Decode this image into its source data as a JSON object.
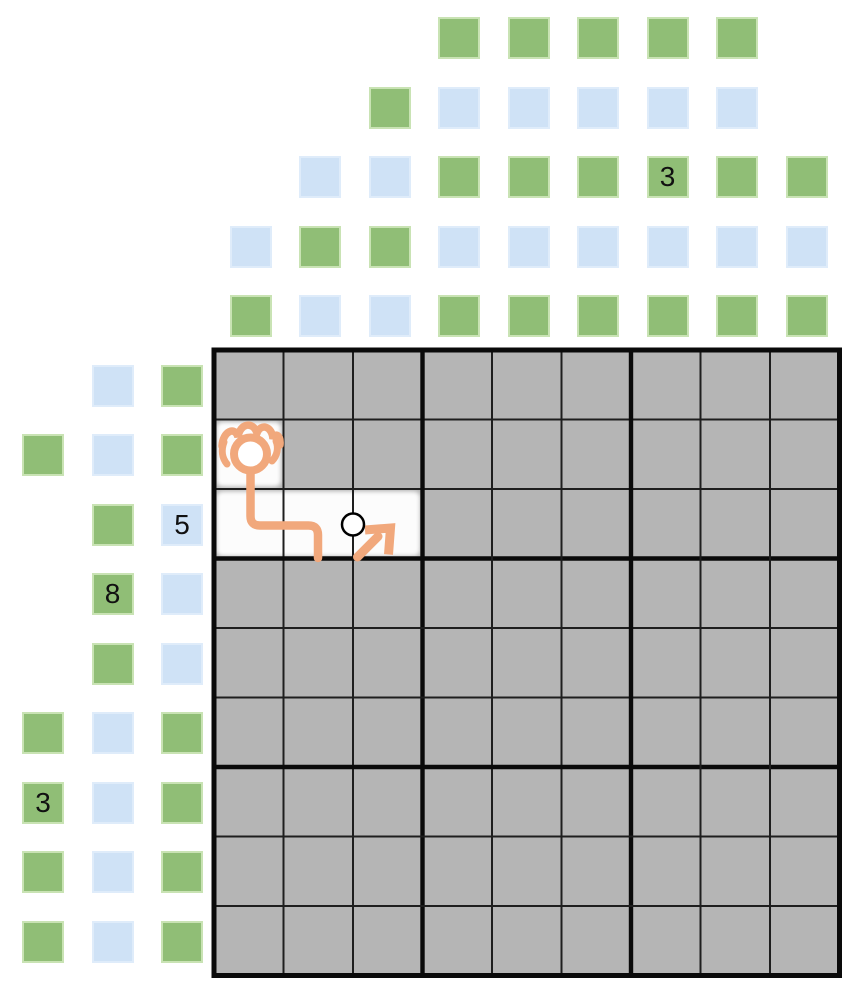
{
  "page": {
    "background": "#ffffff"
  },
  "colors": {
    "cell_gray": "#b5b5b5",
    "grid_line_thin": "#1e1e1e",
    "grid_line_thick": "#0a0a0a",
    "green_fill": "#90be76",
    "green_border": "#c9e3b4",
    "blue_fill": "#cfe2f6",
    "blue_border": "#dfecfa",
    "highlight_white": "#ffffff",
    "annotation_orange": "#f1a87c",
    "marker_outline": "#000000",
    "label_text": "#111111"
  },
  "board": {
    "grid": {
      "rows": 9,
      "cols": 9,
      "box_rows": 3,
      "box_cols": 3,
      "highlighted_cells": [
        {
          "row": 2,
          "col": 1
        },
        {
          "row": 3,
          "col": 1
        },
        {
          "row": 3,
          "col": 2
        },
        {
          "row": 3,
          "col": 3
        }
      ]
    },
    "annotation": {
      "type": "hand-drawn-player-path",
      "head_cell": {
        "row": 2,
        "col": 1
      },
      "path": "head in row2-col1, line down into row3-col1, right through row3-col2, short drop at its right edge",
      "node_marker_between": [
        {
          "row": 3,
          "col": 2
        },
        {
          "row": 3,
          "col": 3
        }
      ],
      "arrow_cell": {
        "row": 3,
        "col": 3
      },
      "arrow_direction": "up-right"
    }
  },
  "top_clues": {
    "rows": [
      {
        "offset": 5,
        "cells": [
          {
            "col": 4,
            "color": "green"
          },
          {
            "col": 5,
            "color": "green"
          },
          {
            "col": 6,
            "color": "green"
          },
          {
            "col": 7,
            "color": "green"
          },
          {
            "col": 8,
            "color": "green"
          }
        ]
      },
      {
        "offset": 4,
        "cells": [
          {
            "col": 3,
            "color": "green"
          },
          {
            "col": 4,
            "color": "blue"
          },
          {
            "col": 5,
            "color": "blue"
          },
          {
            "col": 6,
            "color": "blue"
          },
          {
            "col": 7,
            "color": "blue"
          },
          {
            "col": 8,
            "color": "blue"
          }
        ]
      },
      {
        "offset": 3,
        "cells": [
          {
            "col": 2,
            "color": "blue"
          },
          {
            "col": 3,
            "color": "blue"
          },
          {
            "col": 4,
            "color": "green"
          },
          {
            "col": 5,
            "color": "green"
          },
          {
            "col": 6,
            "color": "green"
          },
          {
            "col": 7,
            "color": "green",
            "label": "3"
          },
          {
            "col": 8,
            "color": "green"
          },
          {
            "col": 9,
            "color": "green"
          }
        ]
      },
      {
        "offset": 2,
        "cells": [
          {
            "col": 1,
            "color": "blue"
          },
          {
            "col": 2,
            "color": "green"
          },
          {
            "col": 3,
            "color": "green"
          },
          {
            "col": 4,
            "color": "blue"
          },
          {
            "col": 5,
            "color": "blue"
          },
          {
            "col": 6,
            "color": "blue"
          },
          {
            "col": 7,
            "color": "blue"
          },
          {
            "col": 8,
            "color": "blue"
          },
          {
            "col": 9,
            "color": "blue"
          }
        ]
      },
      {
        "offset": 1,
        "cells": [
          {
            "col": 1,
            "color": "green"
          },
          {
            "col": 2,
            "color": "blue"
          },
          {
            "col": 3,
            "color": "blue"
          },
          {
            "col": 4,
            "color": "green"
          },
          {
            "col": 5,
            "color": "green"
          },
          {
            "col": 6,
            "color": "green"
          },
          {
            "col": 7,
            "color": "green"
          },
          {
            "col": 8,
            "color": "green"
          },
          {
            "col": 9,
            "color": "green"
          }
        ]
      }
    ]
  },
  "left_clues": {
    "columns": [
      {
        "offset": 3,
        "cells": [
          {
            "row": 2,
            "color": "green"
          },
          {
            "row": 6,
            "color": "green"
          },
          {
            "row": 7,
            "color": "green",
            "label": "3"
          },
          {
            "row": 8,
            "color": "green"
          },
          {
            "row": 9,
            "color": "green"
          }
        ]
      },
      {
        "offset": 2,
        "cells": [
          {
            "row": 1,
            "color": "blue"
          },
          {
            "row": 2,
            "color": "blue"
          },
          {
            "row": 3,
            "color": "green"
          },
          {
            "row": 4,
            "color": "green",
            "label": "8"
          },
          {
            "row": 5,
            "color": "green"
          },
          {
            "row": 6,
            "color": "blue"
          },
          {
            "row": 7,
            "color": "blue"
          },
          {
            "row": 8,
            "color": "blue"
          },
          {
            "row": 9,
            "color": "blue"
          }
        ]
      },
      {
        "offset": 1,
        "cells": [
          {
            "row": 1,
            "color": "green"
          },
          {
            "row": 2,
            "color": "green"
          },
          {
            "row": 3,
            "color": "blue",
            "label": "5"
          },
          {
            "row": 4,
            "color": "blue"
          },
          {
            "row": 5,
            "color": "blue"
          },
          {
            "row": 6,
            "color": "green"
          },
          {
            "row": 7,
            "color": "green"
          },
          {
            "row": 8,
            "color": "green"
          },
          {
            "row": 9,
            "color": "green"
          }
        ]
      }
    ]
  }
}
